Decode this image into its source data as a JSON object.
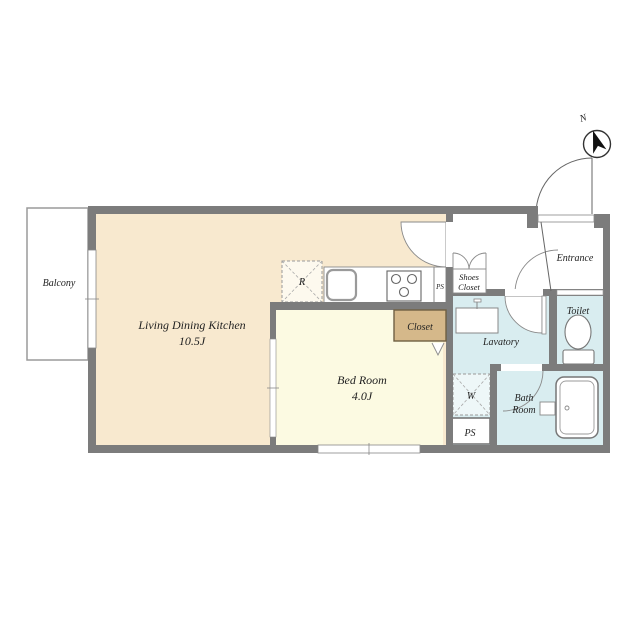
{
  "title": "Apartment floor plan",
  "colors": {
    "wall": "#7c7c7c",
    "ldk_floor": "#f8e9cf",
    "bedroom_floor": "#fcfae2",
    "wet_floor": "#d9edf0",
    "closet_fill": "#d5b88a",
    "closet_border": "#6f5f42",
    "line": "#8a8a8a",
    "text": "#222222"
  },
  "rooms": {
    "balcony": {
      "label": "Balcony"
    },
    "ldk": {
      "label": "Living Dining Kitchen",
      "size": "10.5J"
    },
    "bedroom": {
      "label": "Bed Room",
      "size": "4.0J"
    },
    "closet": {
      "label": "Closet"
    },
    "shoes_closet": {
      "label_line1": "Shoes",
      "label_line2": "Closet"
    },
    "entrance": {
      "label": "Entrance"
    },
    "lavatory": {
      "label": "Lavatory"
    },
    "toilet": {
      "label": "Toilet"
    },
    "bathroom": {
      "label_line1": "Bath",
      "label_line2": "Room"
    },
    "ps_upper": {
      "label": "PS"
    },
    "ps_lower": {
      "label": "PS"
    }
  },
  "fixtures": {
    "refrigerator": {
      "label": "R"
    },
    "washer": {
      "label": "W"
    }
  },
  "compass": {
    "label": "N"
  }
}
